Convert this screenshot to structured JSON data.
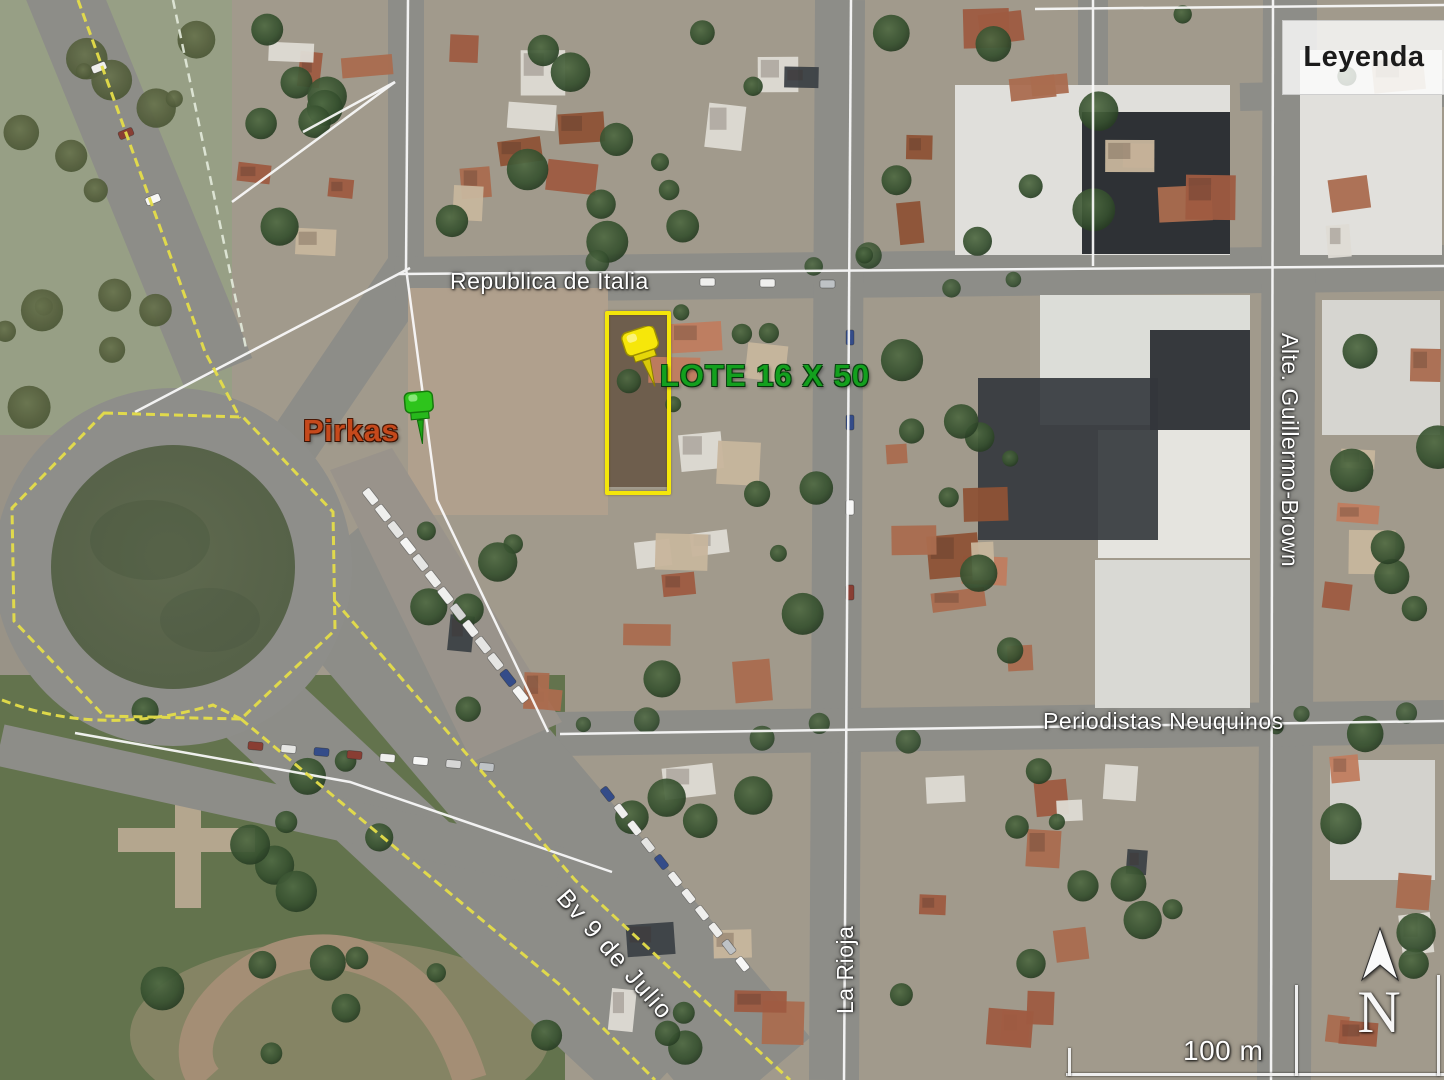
{
  "legend": {
    "title": "Leyenda"
  },
  "streets": [
    {
      "id": "republica-de-italia",
      "text": "Republica de Italia"
    },
    {
      "id": "alte-guillermo-brown",
      "text": "Alte. Guillermo-Brown"
    },
    {
      "id": "periodistas-neuquinos",
      "text": "Periodistas Neuquinos"
    },
    {
      "id": "bv-9-de-julio",
      "text": "Bv 9 de Julio"
    },
    {
      "id": "la-rioja",
      "text": "La Rioja"
    }
  ],
  "annotations": {
    "lot_label": "LOTE 16 X 50",
    "place_label": "Pirkas"
  },
  "compass": {
    "north_label": "N"
  },
  "scale": {
    "label": "100 m"
  },
  "colors": {
    "lot_outline": "#f4e60a",
    "lot_label_green": "#13a01e",
    "place_label_orange": "#c5491c",
    "overlay_yellow": "#e9e23b",
    "street_label_white": "#ffffff",
    "legend_text": "#1c1c1c"
  }
}
